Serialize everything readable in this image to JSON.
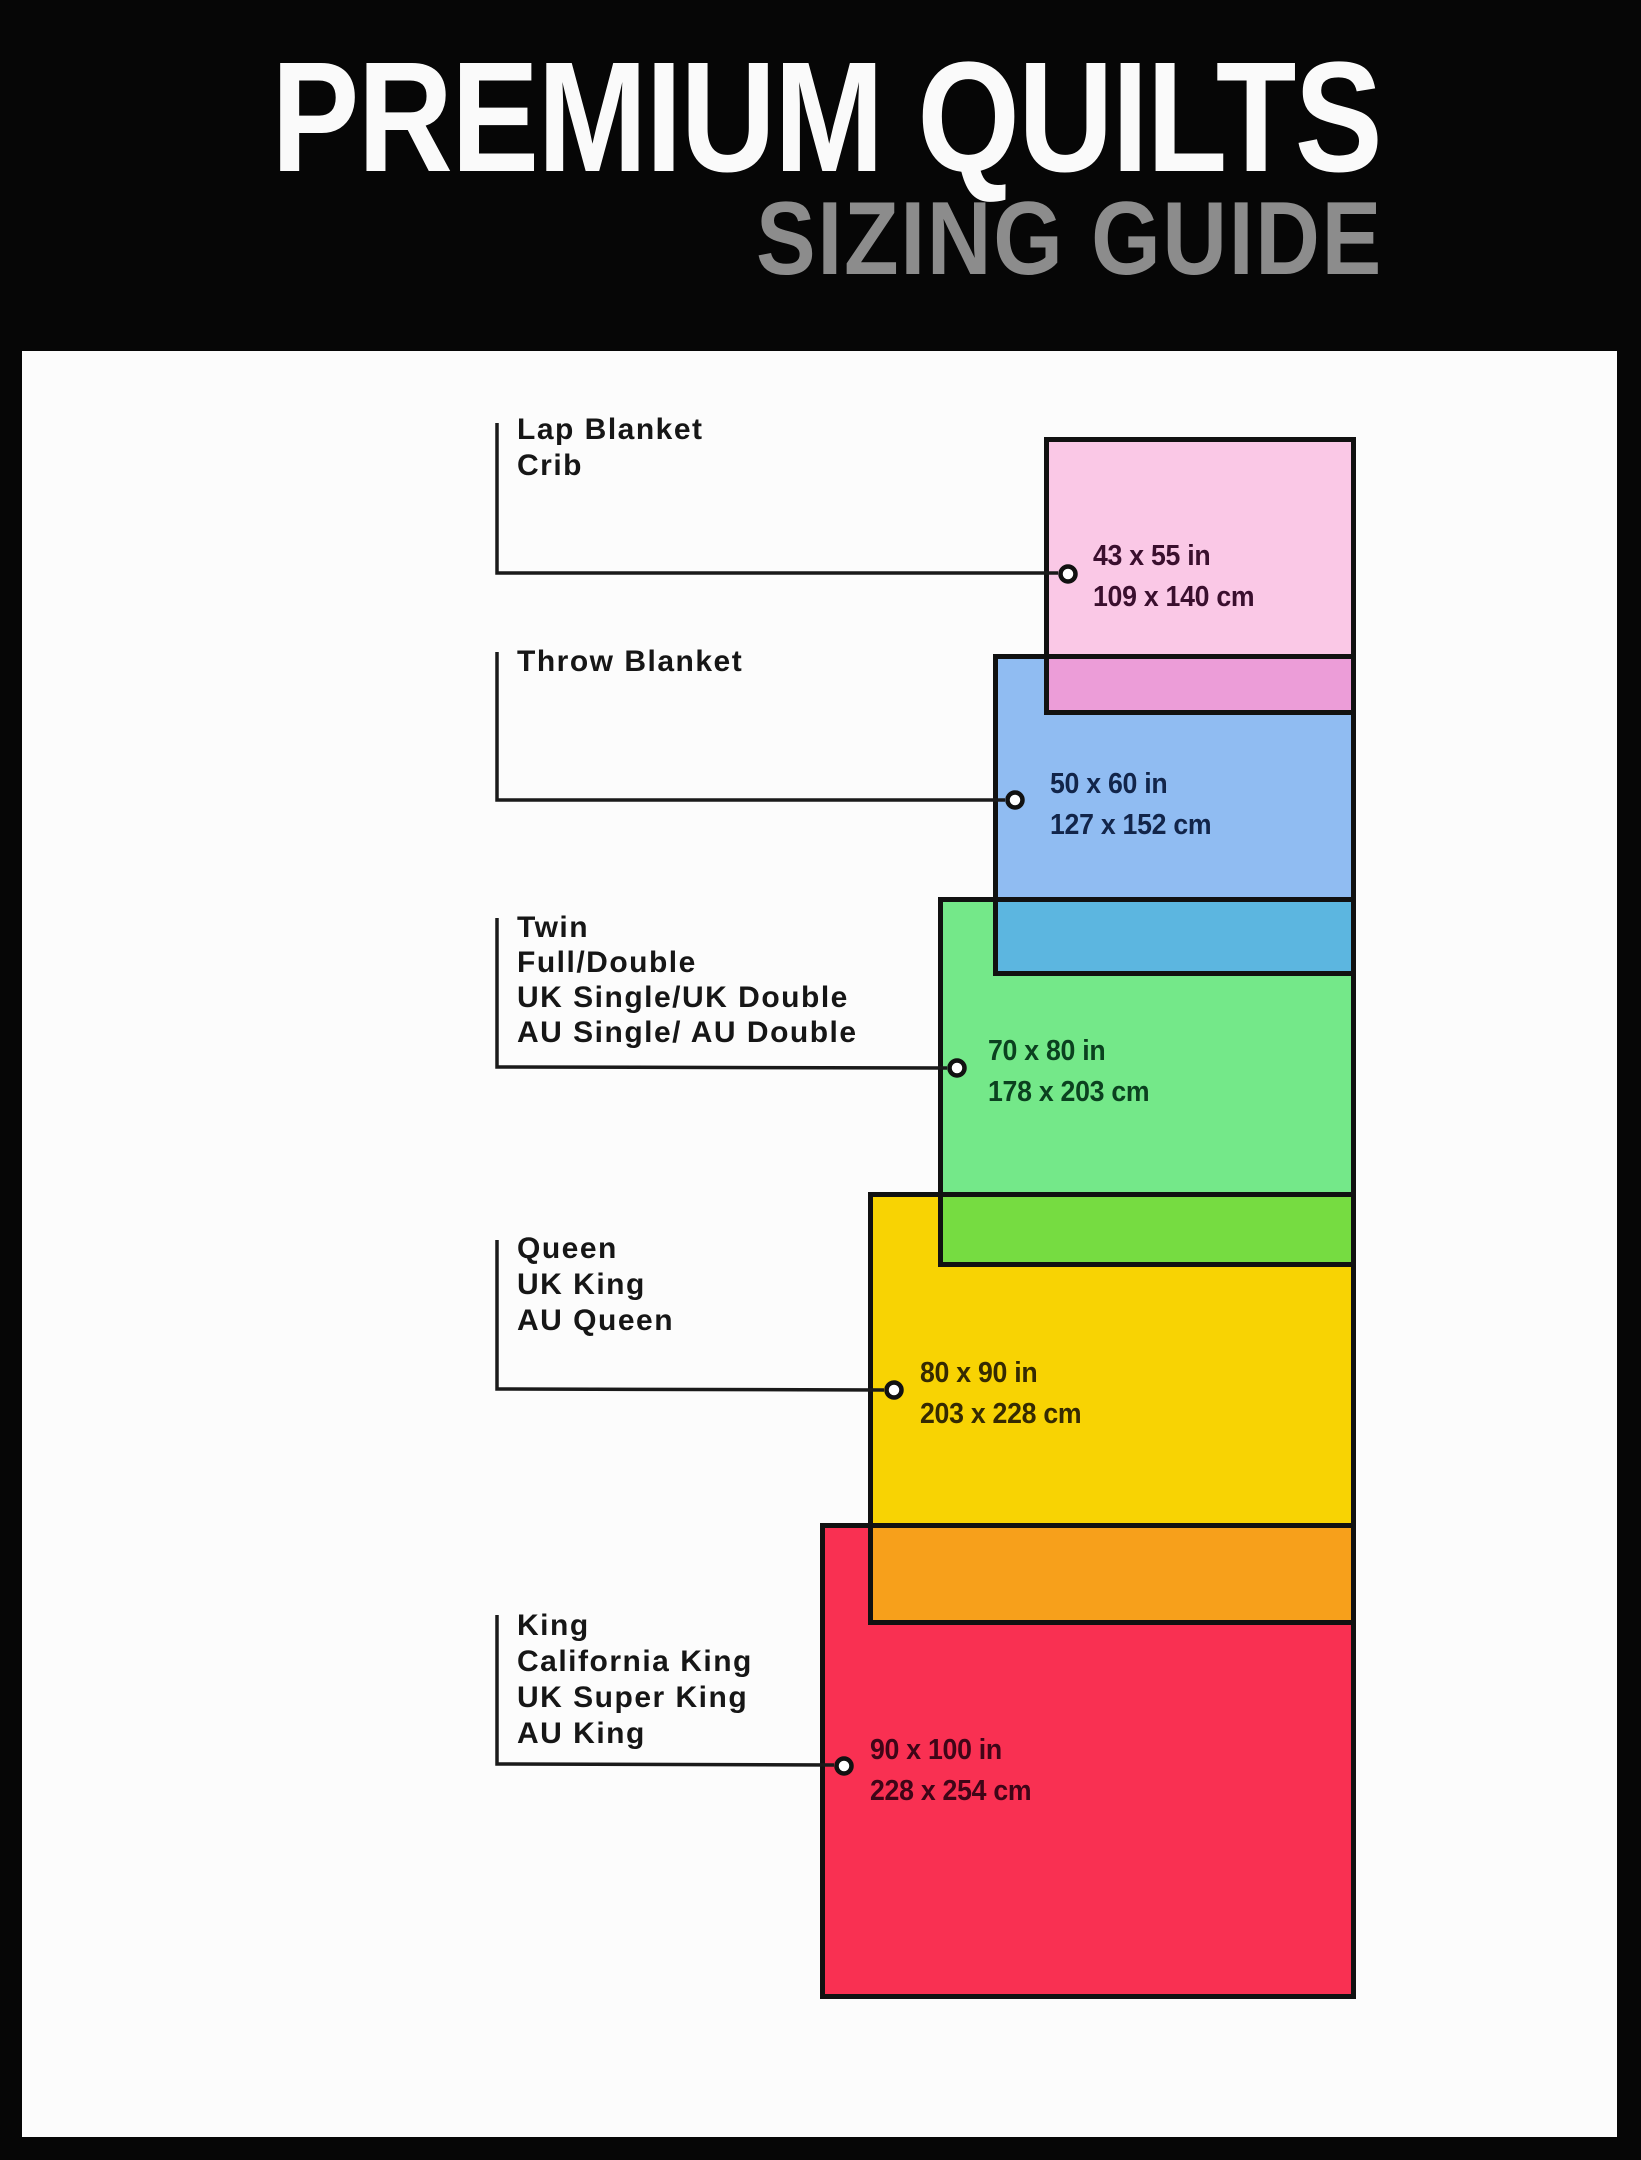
{
  "header": {
    "title": "PREMIUM QUILTS",
    "subtitle": "SIZING GUIDE"
  },
  "styles": {
    "panel_background": "#FCFCFC",
    "frame_color": "#060606",
    "box_border_color": "#111111",
    "connector_color": "#1A1A1A",
    "label_color": "#161616",
    "title_color": "#FAFAFA",
    "subtitle_color": "#8C8C8C"
  },
  "sizes": [
    {
      "labels": [
        "Lap Blanket",
        "Crib"
      ],
      "inches": "43 x 55 in",
      "cm": "109 x 140 cm",
      "fill": "#FAC8E6",
      "overlap_fill": "#EC9DD8",
      "text_color": "#3A0F2E"
    },
    {
      "labels": [
        "Throw Blanket"
      ],
      "inches": "50 x 60 in",
      "cm": "127 x 152 cm",
      "fill": "#90BCF2",
      "overlap_fill": "#5CB6E0",
      "text_color": "#12254A"
    },
    {
      "labels": [
        "Twin",
        "Full/Double",
        "UK Single/UK Double",
        "AU Single/ AU Double"
      ],
      "inches": "70 x 80 in",
      "cm": "178 x 203 cm",
      "fill": "#74E889",
      "overlap_fill": "#76DC41",
      "text_color": "#0B411F"
    },
    {
      "labels": [
        "Queen",
        "UK King",
        "AU Queen"
      ],
      "inches": "80 x 90 in",
      "cm": "203 x 228 cm",
      "fill": "#F8D303",
      "overlap_fill": "#F7A01B",
      "text_color": "#352A02"
    },
    {
      "labels": [
        "King",
        "California King",
        "UK Super King",
        "AU King"
      ],
      "inches": "90 x 100 in",
      "cm": "228 x 254 cm",
      "fill": "#F93052",
      "text_color": "#3E0517"
    }
  ]
}
